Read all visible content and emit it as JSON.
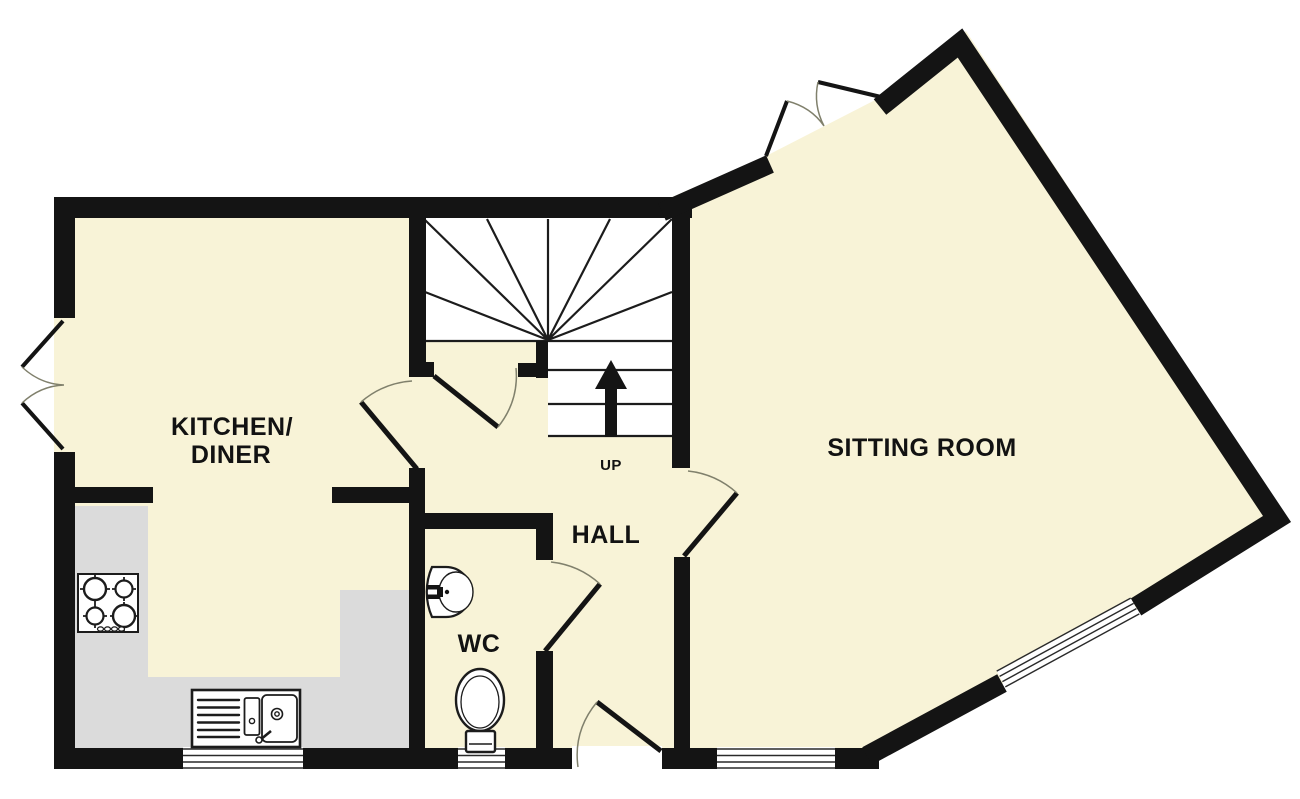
{
  "title": "Ground floor plan",
  "labels": {
    "kitchen_line1": "KITCHEN/",
    "kitchen_line2": "DINER",
    "sitting_room": "SITTING ROOM",
    "hall": "HALL",
    "wc": "WC",
    "up": "UP"
  },
  "colors": {
    "wall": "#141414",
    "floor": "#f8f3d7",
    "counter": "#dbdbdb",
    "door_arc": "#80806c",
    "background": "#ffffff",
    "line": "#1c1c1c"
  },
  "icons": {
    "up_arrow": "stairs-direction-arrow",
    "hob": "four-burner-hob",
    "sink": "kitchen-sink-with-drainer",
    "basin": "wash-basin",
    "toilet": "toilet"
  }
}
